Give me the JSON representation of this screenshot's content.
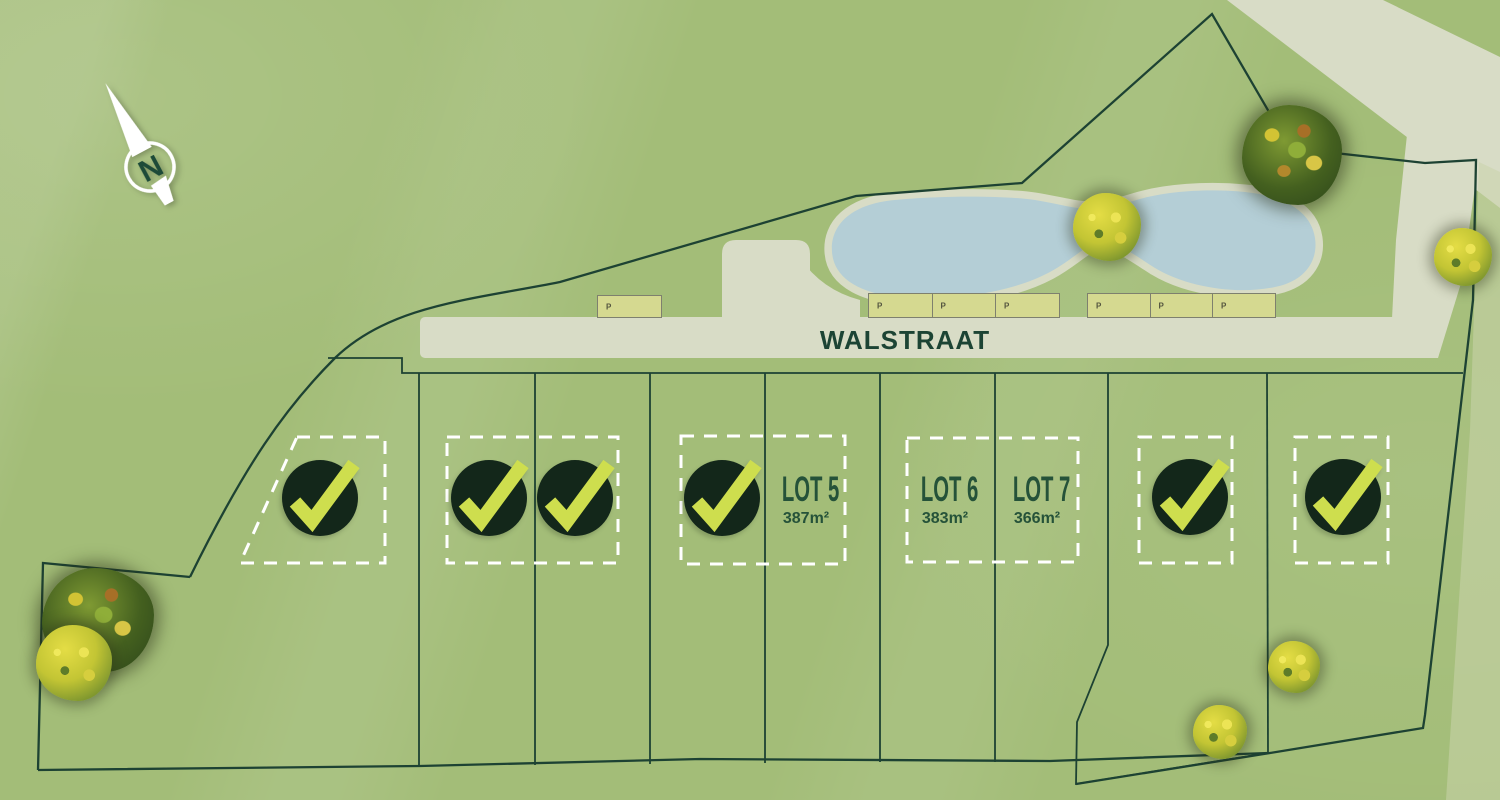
{
  "street": {
    "name": "WALSTRAAT"
  },
  "compass": {
    "letter": "N"
  },
  "parking": {
    "groups": [
      {
        "spots": [
          "P"
        ]
      },
      {
        "spots": [
          "P",
          "P",
          "P"
        ]
      },
      {
        "spots": [
          "P",
          "P",
          "P"
        ]
      }
    ]
  },
  "lots": [
    {
      "id": 1,
      "status": "sold"
    },
    {
      "id": 2,
      "status": "sold"
    },
    {
      "id": 3,
      "status": "sold"
    },
    {
      "id": 4,
      "status": "sold"
    },
    {
      "id": 5,
      "status": "available",
      "label": "LOT 5",
      "area": "387m²"
    },
    {
      "id": 6,
      "status": "available",
      "label": "LOT 6",
      "area": "383m²"
    },
    {
      "id": 7,
      "status": "available",
      "label": "LOT 7",
      "area": "366m²"
    },
    {
      "id": 8,
      "status": "sold"
    },
    {
      "id": 9,
      "status": "sold"
    }
  ],
  "colors": {
    "background": "#a3bd78",
    "road": "#d8dcc6",
    "pond": "#b4ced6",
    "parking_fill": "#d5d990",
    "parking_border": "#7e806e",
    "boundary_line": "#1d4233",
    "sold_circle": "#13271a",
    "check": "#cede4e",
    "lot_text": "#255239",
    "street_text": "#1c4434",
    "dashed_box": "#ffffff"
  }
}
